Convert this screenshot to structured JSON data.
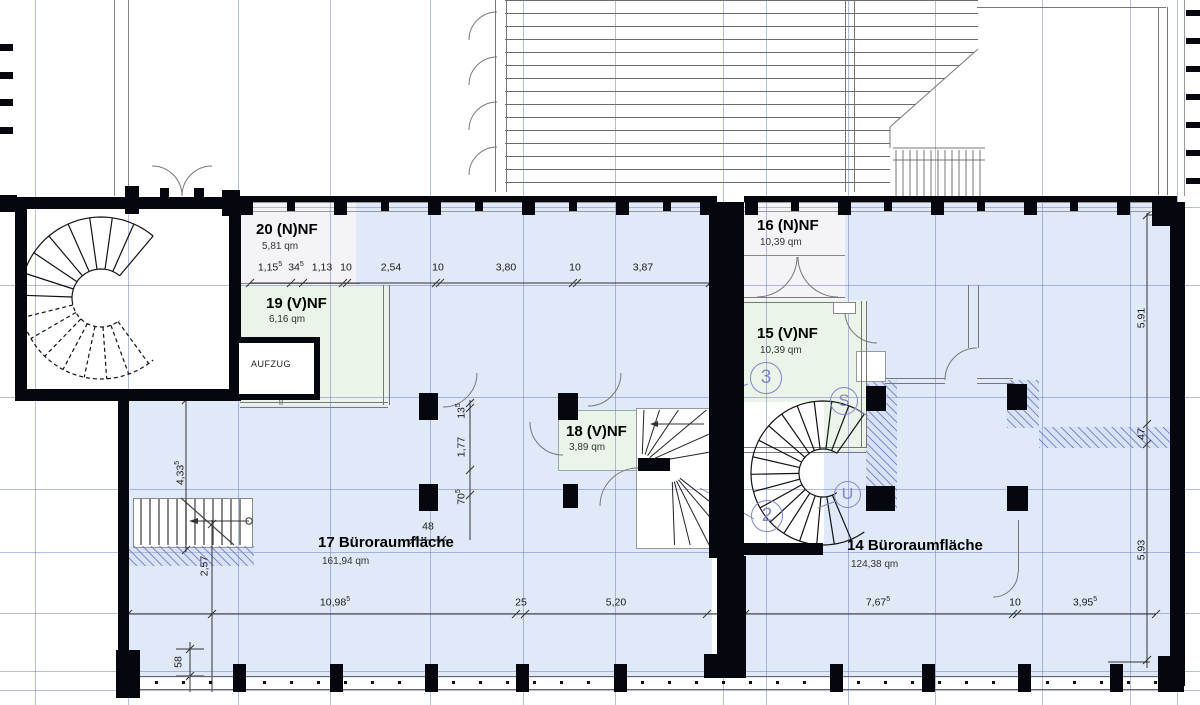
{
  "rooms": {
    "r20": {
      "name": "20 (N)NF",
      "area": "5,81 qm"
    },
    "r19": {
      "name": "19 (V)NF",
      "area": "6,16 qm"
    },
    "r18": {
      "name": "18 (V)NF",
      "area": "3,89 qm"
    },
    "r17": {
      "name": "17 Büroraumfläche",
      "area": "161,94 qm"
    },
    "r16": {
      "name": "16 (N)NF",
      "area": "10,39 qm"
    },
    "r15": {
      "name": "15 (V)NF",
      "area": "10,39 qm"
    },
    "r14": {
      "name": "14 Büroraumfläche",
      "area": "124,38 qm"
    }
  },
  "labels": {
    "elevator": "AUFZUG"
  },
  "markers": {
    "m3": "3",
    "mS": "S",
    "mU": "U",
    "m2": "2"
  },
  "dims": {
    "t1": {
      "v": "1,15",
      "sup": "5"
    },
    "t2": {
      "v": "34",
      "sup": "5"
    },
    "t3": {
      "v": "1,13",
      "sup": ""
    },
    "t4": {
      "v": "10",
      "sup": ""
    },
    "t5": {
      "v": "2,54",
      "sup": ""
    },
    "t6": {
      "v": "10",
      "sup": ""
    },
    "t7": {
      "v": "3,80",
      "sup": ""
    },
    "t8": {
      "v": "10",
      "sup": ""
    },
    "t9": {
      "v": "3,87",
      "sup": ""
    },
    "b1": {
      "v": "10,98",
      "sup": "5"
    },
    "b2": {
      "v": "25",
      "sup": ""
    },
    "b3": {
      "v": "5,20",
      "sup": ""
    },
    "b4": {
      "v": "7,67",
      "sup": "5"
    },
    "b5": {
      "v": "10",
      "sup": ""
    },
    "b6": {
      "v": "3,95",
      "sup": "5"
    },
    "l1": {
      "v": "4,33",
      "sup": "5"
    },
    "l2": {
      "v": "2,57",
      "sup": ""
    },
    "l3": {
      "v": "58",
      "sup": ""
    },
    "mm1": {
      "v": "13",
      "sup": "5"
    },
    "mm2": {
      "v": "1,77",
      "sup": ""
    },
    "mm3": {
      "v": "70",
      "sup": "5"
    },
    "mm4": {
      "v": "48",
      "sup": ""
    },
    "r1": {
      "v": "5,91",
      "sup": ""
    },
    "r2": {
      "v": "47",
      "sup": ""
    },
    "r3": {
      "v": "5,93",
      "sup": ""
    }
  },
  "colors": {
    "room_blue": "#dfe9f8",
    "room_green": "#eaf4e8",
    "room_grey": "#f4f4f8",
    "grid": "#7a84c4",
    "marker": "#8087c8",
    "wall": "#06060e"
  }
}
